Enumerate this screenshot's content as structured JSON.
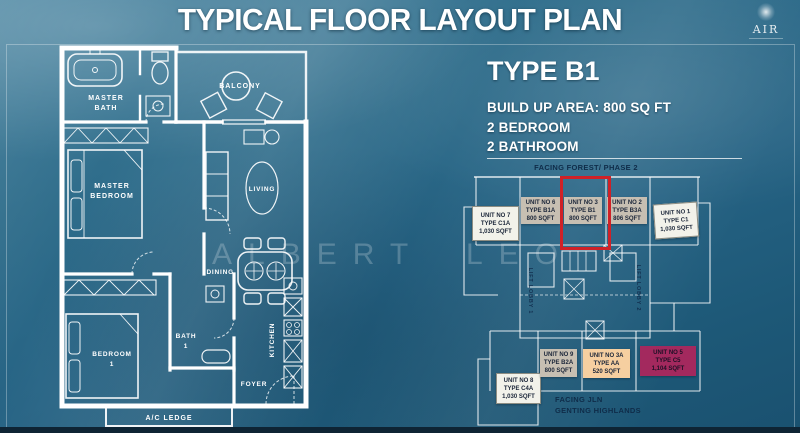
{
  "title": "TYPICAL FLOOR LAYOUT PLAN",
  "logo": {
    "name": "AIR"
  },
  "watermark": "ALBERT LEO",
  "unit_info": {
    "type_heading": "TYPE B1",
    "build_up_area": "BUILD UP AREA: 800 SQ FT",
    "bedroom": "2 BEDROOM",
    "bathroom": "2 BATHROOM"
  },
  "floor_plan": {
    "rooms": {
      "master_bath_line1": "MASTER",
      "master_bath_line2": "BATH",
      "balcony": "BALCONY",
      "master_bedroom_line1": "MASTER",
      "master_bedroom_line2": "BEDROOM",
      "living": "LIVING",
      "dining": "DINING",
      "bedroom1_line1": "BEDROOM",
      "bedroom1_line2": "1",
      "bath1_line1": "BATH",
      "bath1_line2": "1",
      "foyer": "FOYER",
      "kitchen": "KITCHEN",
      "ac_ledge": "A/C LEDGE"
    }
  },
  "site_plan": {
    "facing_top": "FACING FOREST/ PHASE 2",
    "facing_bottom_line1": "FACING JLN",
    "facing_bottom_line2": "GENTING HIGHLANDS",
    "lift_lobby_1": "LIFT LOBBY 1",
    "lift_lobby_2": "LIFT LOBBY 2",
    "colors": {
      "highlight_border": "#cf2127",
      "tan_box": "#c7bfb2",
      "white_box": "#f2f2ea",
      "peach_box": "#f6cfa0",
      "magenta_box": "#a3295e"
    },
    "units": [
      {
        "no": "UNIT NO 7",
        "type": "TYPE C1A",
        "area": "1,030 SQFT"
      },
      {
        "no": "UNIT NO 6",
        "type": "TYPE B1A",
        "area": "800 SQFT"
      },
      {
        "no": "UNIT NO 3",
        "type": "TYPE B1",
        "area": "800 SQFT"
      },
      {
        "no": "UNIT NO 2",
        "type": "TYPE B3A",
        "area": "806 SQFT"
      },
      {
        "no": "UNIT NO 1",
        "type": "TYPE C1",
        "area": "1,030 SQFT"
      },
      {
        "no": "UNIT NO 8",
        "type": "TYPE C4A",
        "area": "1,030 SQFT"
      },
      {
        "no": "UNIT NO 9",
        "type": "TYPE B2A",
        "area": "800 SQFT"
      },
      {
        "no": "UNIT NO 3A",
        "type": "TYPE AA",
        "area": "520 SQFT"
      },
      {
        "no": "UNIT NO 5",
        "type": "TYPE C5",
        "area": "1,104 SQFT"
      }
    ]
  }
}
